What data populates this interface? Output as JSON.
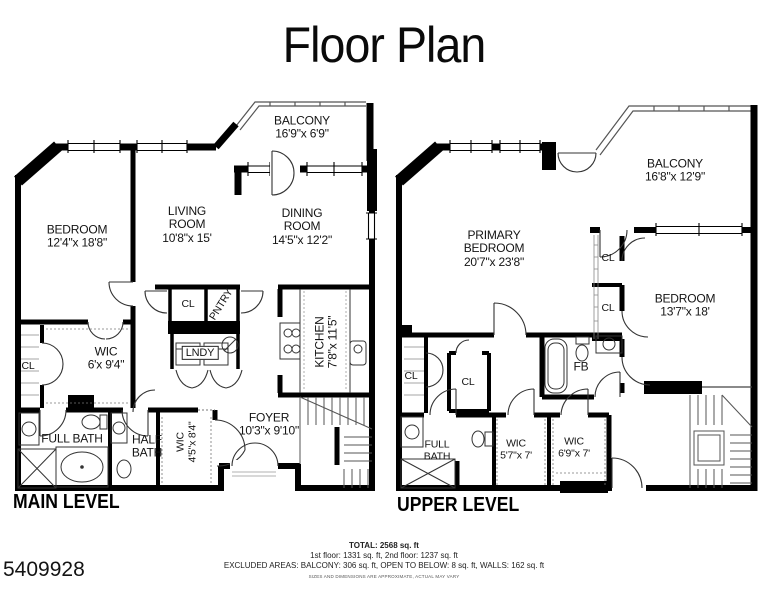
{
  "page": {
    "title": "Floor Plan",
    "listing_id": "5409928"
  },
  "main_level": {
    "label": "MAIN LEVEL",
    "rooms": {
      "balcony": {
        "name": "BALCONY",
        "dims": "16'9\"x 6'9\""
      },
      "bedroom": {
        "name": "BEDROOM",
        "dims": "12'4\"x 18'8\""
      },
      "living_room": {
        "line1": "LIVING",
        "line2": "ROOM",
        "dims": "10'8\"x 15'"
      },
      "dining_room": {
        "line1": "DINING",
        "line2": "ROOM",
        "dims": "14'5\"x 12'2\""
      },
      "closet": {
        "name": "CL"
      },
      "pantry": {
        "name": "PNTRY"
      },
      "laundry": {
        "name": "LNDY"
      },
      "wic": {
        "name": "WIC",
        "dims": "6'x 9'4\""
      },
      "closet_2": {
        "name": "CL"
      },
      "kitchen": {
        "name": "KITCHEN",
        "dims": "7'8\"x 11'5\""
      },
      "full_bath": {
        "name": "FULL BATH"
      },
      "half_bath": {
        "line1": "HALF",
        "line2": "BATH"
      },
      "wic_2": {
        "name": "WIC",
        "dims": "4'5\"x 8'4\""
      },
      "foyer": {
        "name": "FOYER",
        "dims": "10'3\"x 9'10\""
      }
    }
  },
  "upper_level": {
    "label": "UPPER LEVEL",
    "rooms": {
      "balcony": {
        "name": "BALCONY",
        "dims": "16'8\"x 12'9\""
      },
      "primary_bedroom": {
        "line1": "PRIMARY",
        "line2": "BEDROOM",
        "dims": "20'7\"x 23'8\""
      },
      "bedroom": {
        "name": "BEDROOM",
        "dims": "13'7\"x 18'"
      },
      "closet_1": {
        "name": "CL"
      },
      "closet_2": {
        "name": "CL"
      },
      "fb": {
        "name": "FB"
      },
      "closet_3": {
        "name": "CL"
      },
      "closet_4": {
        "name": "CL"
      },
      "full_bath": {
        "line1": "FULL",
        "line2": "BATH"
      },
      "wic_1": {
        "name": "WIC",
        "dims": "5'7\"x 7'"
      },
      "wic_2": {
        "name": "WIC",
        "dims": "6'9\"x 7'"
      }
    }
  },
  "footer": {
    "total": "TOTAL: 2568 sq. ft",
    "floors": "1st floor: 1331 sq. ft, 2nd floor: 1237 sq. ft",
    "excluded": "EXCLUDED AREAS: BALCONY: 306 sq. ft, OPEN TO BELOW: 8 sq. ft, WALLS: 162 sq. ft",
    "disclaimer": "SIZES AND DIMENSIONS ARE APPROXIMATE, ACTUAL MAY VARY"
  },
  "colors": {
    "wall": "#000000",
    "thin_line": "#444444",
    "background": "#ffffff"
  }
}
